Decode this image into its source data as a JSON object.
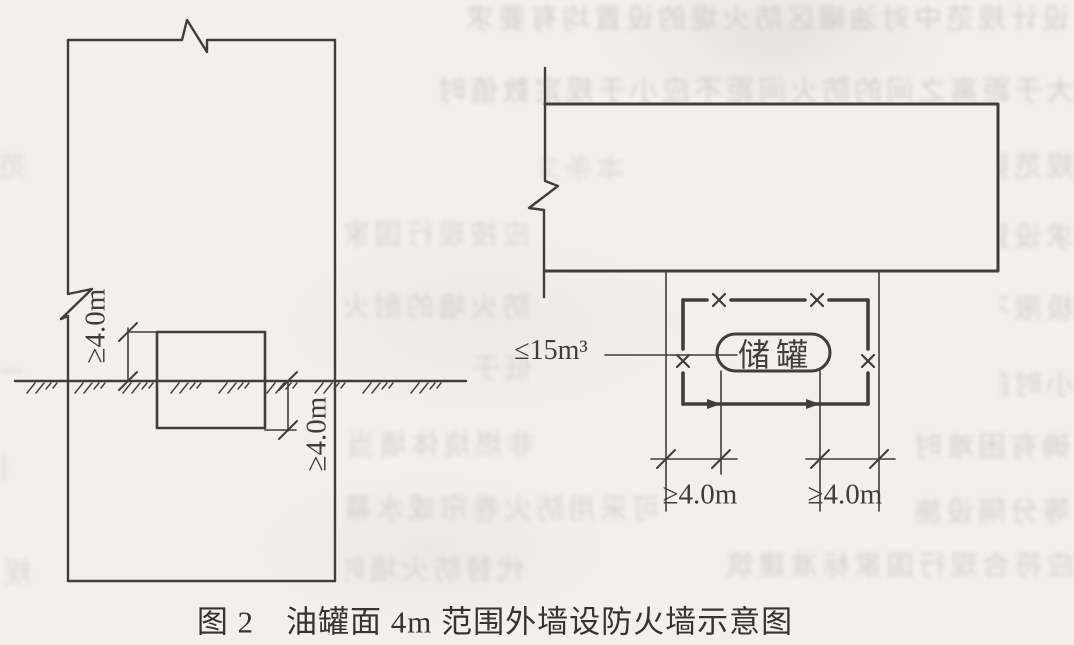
{
  "page": {
    "paper_color": "#f2f0eb",
    "ink_color": "#3f3e3c"
  },
  "figure_caption": "图 2　油罐面 4m 范围外墙设防火墙示意图",
  "left_plan": {
    "upper_dim_label": "≥4.0m",
    "lower_dim_label": "≥4.0m"
  },
  "right_plan": {
    "volume_label": "≤15m³",
    "tank_label": "储罐",
    "left_dim_label": "≥4.0m",
    "right_dim_label": "≥4.0m"
  },
  "bleed_through_texture": {
    "rows": [
      {
        "x": 370,
        "y": 2,
        "w": 700,
        "o": 0.55,
        "t": "设计规范中对油罐区防火堤的设置均有要求"
      },
      {
        "x": 350,
        "y": 74,
        "w": 724,
        "o": 0.55,
        "t": "大于距离之间的防火间距不应小于规定数值时"
      },
      {
        "x": 540,
        "y": 152,
        "w": 84,
        "o": 0.35,
        "t": "本条文"
      },
      {
        "x": 1000,
        "y": 150,
        "w": 74,
        "o": 0.5,
        "t": "规范要"
      },
      {
        "x": 345,
        "y": 218,
        "w": 185,
        "o": 0.45,
        "t": "应按现行国家"
      },
      {
        "x": 1000,
        "y": 220,
        "w": 74,
        "o": 0.5,
        "t": "求设置"
      },
      {
        "x": 345,
        "y": 290,
        "w": 185,
        "o": 0.45,
        "t": "防火墙的耐火"
      },
      {
        "x": 1000,
        "y": 292,
        "w": 74,
        "o": 0.5,
        "t": "极限不"
      },
      {
        "x": 468,
        "y": 352,
        "w": 64,
        "o": 0.4,
        "t": "低于"
      },
      {
        "x": 1000,
        "y": 368,
        "w": 74,
        "o": 0.5,
        "t": "小时的"
      },
      {
        "x": 340,
        "y": 428,
        "w": 195,
        "o": 0.45,
        "t": "非燃烧体墙当"
      },
      {
        "x": 905,
        "y": 430,
        "w": 165,
        "o": 0.5,
        "t": "确有困难时"
      },
      {
        "x": 340,
        "y": 492,
        "w": 320,
        "o": 0.45,
        "t": "可采用防火卷帘或水幕"
      },
      {
        "x": 905,
        "y": 495,
        "w": 165,
        "o": 0.5,
        "t": "等分隔设施"
      },
      {
        "x": 345,
        "y": 553,
        "w": 180,
        "o": 0.45,
        "t": "代替防火墙时"
      },
      {
        "x": 700,
        "y": 549,
        "w": 374,
        "o": 0.5,
        "t": "应符合现行国家标准建筑"
      },
      {
        "x": 0,
        "y": 150,
        "w": 26,
        "o": 0.4,
        "t": "范"
      },
      {
        "x": 0,
        "y": 356,
        "w": 24,
        "o": 0.4,
        "t": "一"
      },
      {
        "x": 0,
        "y": 452,
        "w": 18,
        "o": 0.45,
        "t": "丨"
      },
      {
        "x": 0,
        "y": 556,
        "w": 32,
        "o": 0.4,
        "t": "规"
      }
    ]
  }
}
